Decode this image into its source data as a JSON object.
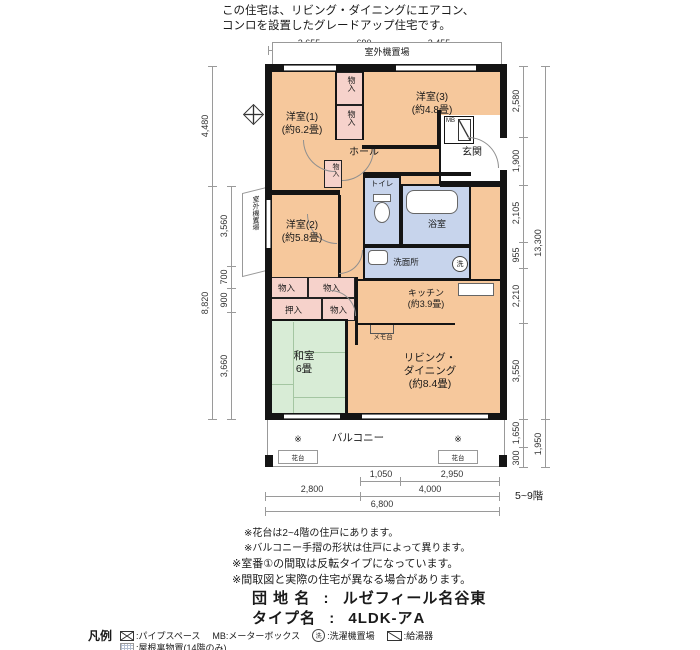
{
  "header": {
    "line1": "この住宅は、リビング・ダイニングにエアコン、",
    "line2": "コンロを設置したグレードアップ住宅です。"
  },
  "plan": {
    "outdoor_top": "室外機置場",
    "outdoor_left": "室外機置場",
    "rooms": {
      "yoshitsu1": {
        "name": "洋室(1)",
        "size": "(約6.2畳)"
      },
      "yoshitsu2": {
        "name": "洋室(2)",
        "size": "(約5.8畳)"
      },
      "yoshitsu3": {
        "name": "洋室(3)",
        "size": "(約4.8畳)"
      },
      "washitsu": {
        "name": "和室",
        "size": "6畳"
      },
      "living": {
        "l1": "リビング・",
        "l2": "ダイニング",
        "size": "(約8.4畳)"
      },
      "kitchen": {
        "name": "キッチン",
        "size": "(約3.9畳)"
      },
      "hall": "ホール",
      "genkan": "玄関",
      "toilet": "トイレ",
      "bath": "浴室",
      "wash": "洗面所",
      "balcony": "バルコニー"
    },
    "labels": {
      "monoiri": "物入",
      "oshiire": "押入",
      "mb": "MB",
      "memodai": "メモ台",
      "hanadai": "花台",
      "kome": "※",
      "wash_mark": "洗"
    }
  },
  "dims": {
    "top": [
      "2,655",
      "690",
      "3,455"
    ],
    "left_outer": [
      "4,480",
      "8,820"
    ],
    "left_inner": [
      "3,560",
      "700",
      "900",
      "3,660"
    ],
    "right_inner": [
      "2,580",
      "1,900",
      "2,105",
      "955",
      "2,210",
      "3,550",
      "1,650",
      "300"
    ],
    "right_outer": [
      "13,300",
      "1,950"
    ],
    "bottom_r1": [
      "1,050",
      "2,950"
    ],
    "bottom_r2": [
      "2,800",
      "4,000"
    ],
    "bottom_r3": "6,800",
    "floors": "5~9階"
  },
  "notes": [
    "※花台は2~4階の住戸にあります。",
    "※バルコニー手摺の形状は住戸によって異ります。",
    "※室番①の間取は反転タイプになっています。",
    "※間取図と実際の住宅が異なる場合があります。"
  ],
  "info": {
    "estate_label": "団 地 名",
    "estate_sep": ":",
    "estate_value": "ルゼフィール名谷東",
    "type_label": "タイプ名",
    "type_sep": ":",
    "type_value": "4LDK-アA"
  },
  "legend": {
    "title": "凡例",
    "pipe_label": ":パイプスペース",
    "mb_label": "MB:メーターボックス",
    "wash_mark": "洗",
    "wash_label": ":洗濯機置場",
    "heater_label": ":給湯器",
    "attic_label": ":屋根裏物置(14階のみ)"
  }
}
